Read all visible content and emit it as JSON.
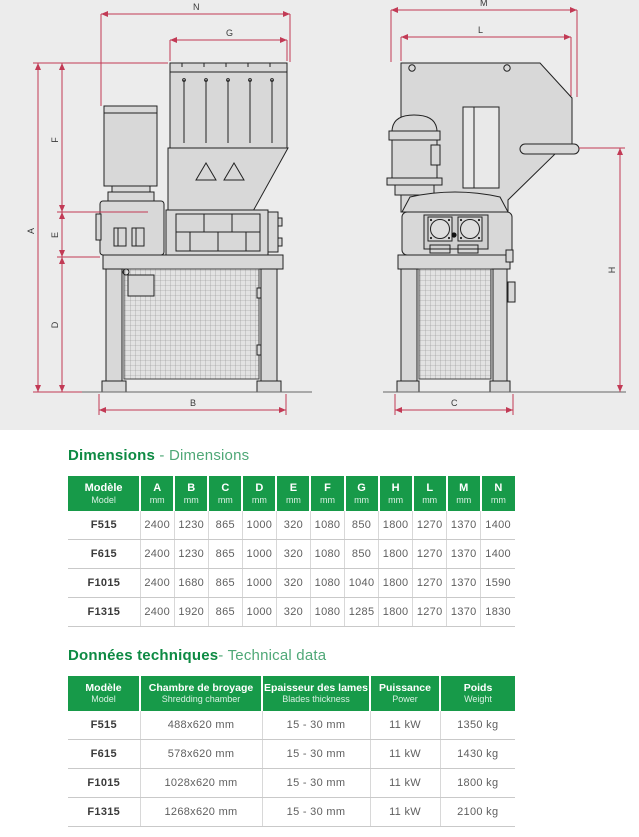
{
  "drawing": {
    "dims": {
      "A": "A",
      "B": "B",
      "C": "C",
      "D": "D",
      "E": "E",
      "F": "F",
      "G": "G",
      "H": "H",
      "L": "L",
      "M": "M",
      "N": "N"
    }
  },
  "colors": {
    "accent_green": "#179a49",
    "title_green": "#0d8a43",
    "dim_red": "#c23a55"
  },
  "dimensions_section": {
    "title_fr": "Dimensions",
    "title_sep": " - ",
    "title_en": "Dimensions",
    "table": {
      "model_col": {
        "fr": "Modèle",
        "en": "Model"
      },
      "columns": [
        {
          "letter": "A",
          "unit": "mm"
        },
        {
          "letter": "B",
          "unit": "mm"
        },
        {
          "letter": "C",
          "unit": "mm"
        },
        {
          "letter": "D",
          "unit": "mm"
        },
        {
          "letter": "E",
          "unit": "mm"
        },
        {
          "letter": "F",
          "unit": "mm"
        },
        {
          "letter": "G",
          "unit": "mm"
        },
        {
          "letter": "H",
          "unit": "mm"
        },
        {
          "letter": "L",
          "unit": "mm"
        },
        {
          "letter": "M",
          "unit": "mm"
        },
        {
          "letter": "N",
          "unit": "mm"
        }
      ],
      "rows": [
        {
          "model": "F515",
          "values": [
            "2400",
            "1230",
            "865",
            "1000",
            "320",
            "1080",
            "850",
            "1800",
            "1270",
            "1370",
            "1400"
          ]
        },
        {
          "model": "F615",
          "values": [
            "2400",
            "1230",
            "865",
            "1000",
            "320",
            "1080",
            "850",
            "1800",
            "1270",
            "1370",
            "1400"
          ]
        },
        {
          "model": "F1015",
          "values": [
            "2400",
            "1680",
            "865",
            "1000",
            "320",
            "1080",
            "1040",
            "1800",
            "1270",
            "1370",
            "1590"
          ]
        },
        {
          "model": "F1315",
          "values": [
            "2400",
            "1920",
            "865",
            "1000",
            "320",
            "1080",
            "1285",
            "1800",
            "1270",
            "1370",
            "1830"
          ]
        }
      ]
    }
  },
  "technical_section": {
    "title_fr": "Données techniques",
    "title_sep": "- ",
    "title_en": "Technical data",
    "table": {
      "columns": [
        {
          "fr": "Modèle",
          "en": "Model"
        },
        {
          "fr": "Chambre de broyage",
          "en": "Shredding chamber"
        },
        {
          "fr": "Epaisseur des lames",
          "en": "Blades thickness"
        },
        {
          "fr": "Puissance",
          "en": "Power"
        },
        {
          "fr": "Poids",
          "en": "Weight"
        }
      ],
      "rows": [
        {
          "model": "F515",
          "chamber": "488x620 mm",
          "blades": "15 - 30 mm",
          "power": "11 kW",
          "weight": "1350 kg"
        },
        {
          "model": "F615",
          "chamber": "578x620 mm",
          "blades": "15 - 30 mm",
          "power": "11 kW",
          "weight": "1430 kg"
        },
        {
          "model": "F1015",
          "chamber": "1028x620 mm",
          "blades": "15 - 30 mm",
          "power": "11 kW",
          "weight": "1800 kg"
        },
        {
          "model": "F1315",
          "chamber": "1268x620 mm",
          "blades": "15 - 30 mm",
          "power": "11 kW",
          "weight": "2100 kg"
        }
      ]
    }
  }
}
